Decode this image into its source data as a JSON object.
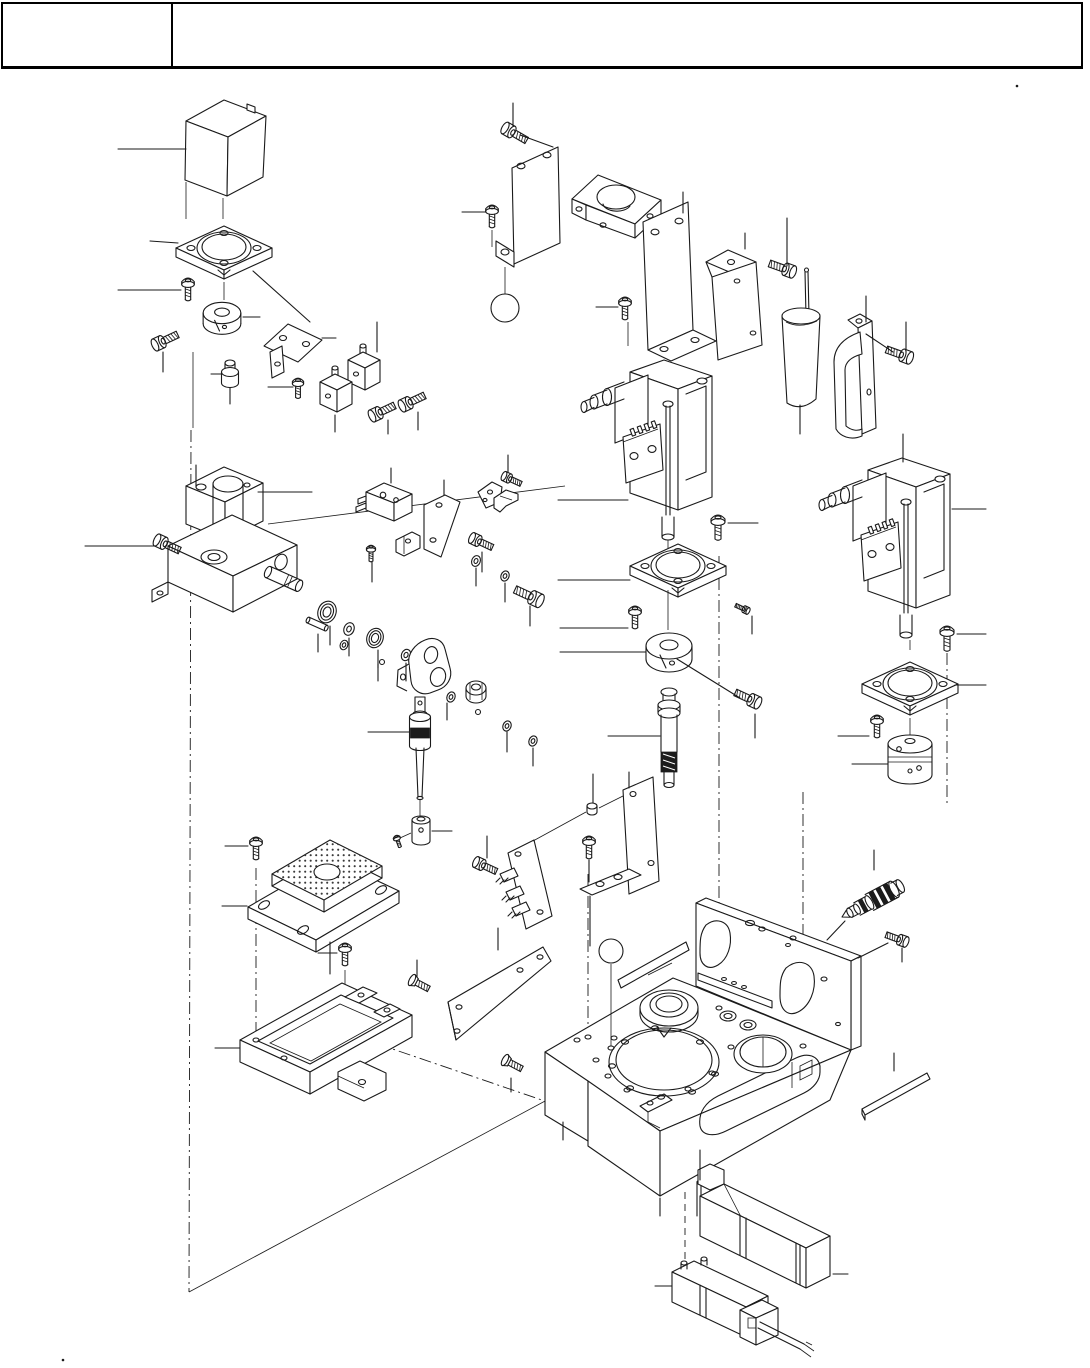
{
  "page": {
    "background_color": "#ffffff",
    "line_color": "#1a1a1a",
    "width_px": 1090,
    "height_px": 1368
  },
  "header": {
    "left_cell_text": "",
    "right_cell_text": ""
  },
  "diagram": {
    "type": "exploded-assembly-parts-diagram",
    "visible_text": [],
    "callout_numbers_visible": false,
    "parts": [
      {
        "name": "sensor-cover-box"
      },
      {
        "name": "mount-flange-plate"
      },
      {
        "name": "shaft-collar-small"
      },
      {
        "name": "pan-head-screw"
      },
      {
        "name": "socket-head-screw"
      },
      {
        "name": "shoulder-bushing"
      },
      {
        "name": "flat-mounting-bracket"
      },
      {
        "name": "guide-block-upper"
      },
      {
        "name": "guide-block-lower"
      },
      {
        "name": "side-plate-left"
      },
      {
        "name": "steel-ball"
      },
      {
        "name": "shaft-saddle-clamp"
      },
      {
        "name": "side-plate-right"
      },
      {
        "name": "angle-bracket"
      },
      {
        "name": "electrolytic-capacitor"
      },
      {
        "name": "capacitor-clamp"
      },
      {
        "name": "bearing-housing-block"
      },
      {
        "name": "micro-switch"
      },
      {
        "name": "switch-plate-bracket"
      },
      {
        "name": "switch-angle-bracket"
      },
      {
        "name": "hook-bracket"
      },
      {
        "name": "set-screw"
      },
      {
        "name": "idler-shaft-pin"
      },
      {
        "name": "dowel-pin"
      },
      {
        "name": "ball-bearing-front"
      },
      {
        "name": "ball-bearing-rear"
      },
      {
        "name": "spacer-washer"
      },
      {
        "name": "retaining-ring"
      },
      {
        "name": "pivot-lever-arm"
      },
      {
        "name": "hex-nut-bushing"
      },
      {
        "name": "spindle-shaft"
      },
      {
        "name": "shaft-coupler-sleeve"
      },
      {
        "name": "stepper-motor-left"
      },
      {
        "name": "motor-flange-left"
      },
      {
        "name": "shaft-collar-motor"
      },
      {
        "name": "worm-gear-shaft"
      },
      {
        "name": "stepper-motor-right"
      },
      {
        "name": "motor-flange-right"
      },
      {
        "name": "flexible-coupling"
      },
      {
        "name": "perforated-grid-plate"
      },
      {
        "name": "grid-base-plate"
      },
      {
        "name": "connector-pcb"
      },
      {
        "name": "pcb-standoff-spacer"
      },
      {
        "name": "pcb-mounting-bracket"
      },
      {
        "name": "sheet-metal-tray"
      },
      {
        "name": "cover-plate"
      },
      {
        "name": "flat-head-screw"
      },
      {
        "name": "main-base-block"
      },
      {
        "name": "label-strip-plate"
      },
      {
        "name": "cartridge-sensor"
      },
      {
        "name": "side-strip-plate"
      },
      {
        "name": "solenoid-valve-upper"
      },
      {
        "name": "solenoid-valve-lower"
      },
      {
        "name": "valve-cable"
      }
    ]
  }
}
